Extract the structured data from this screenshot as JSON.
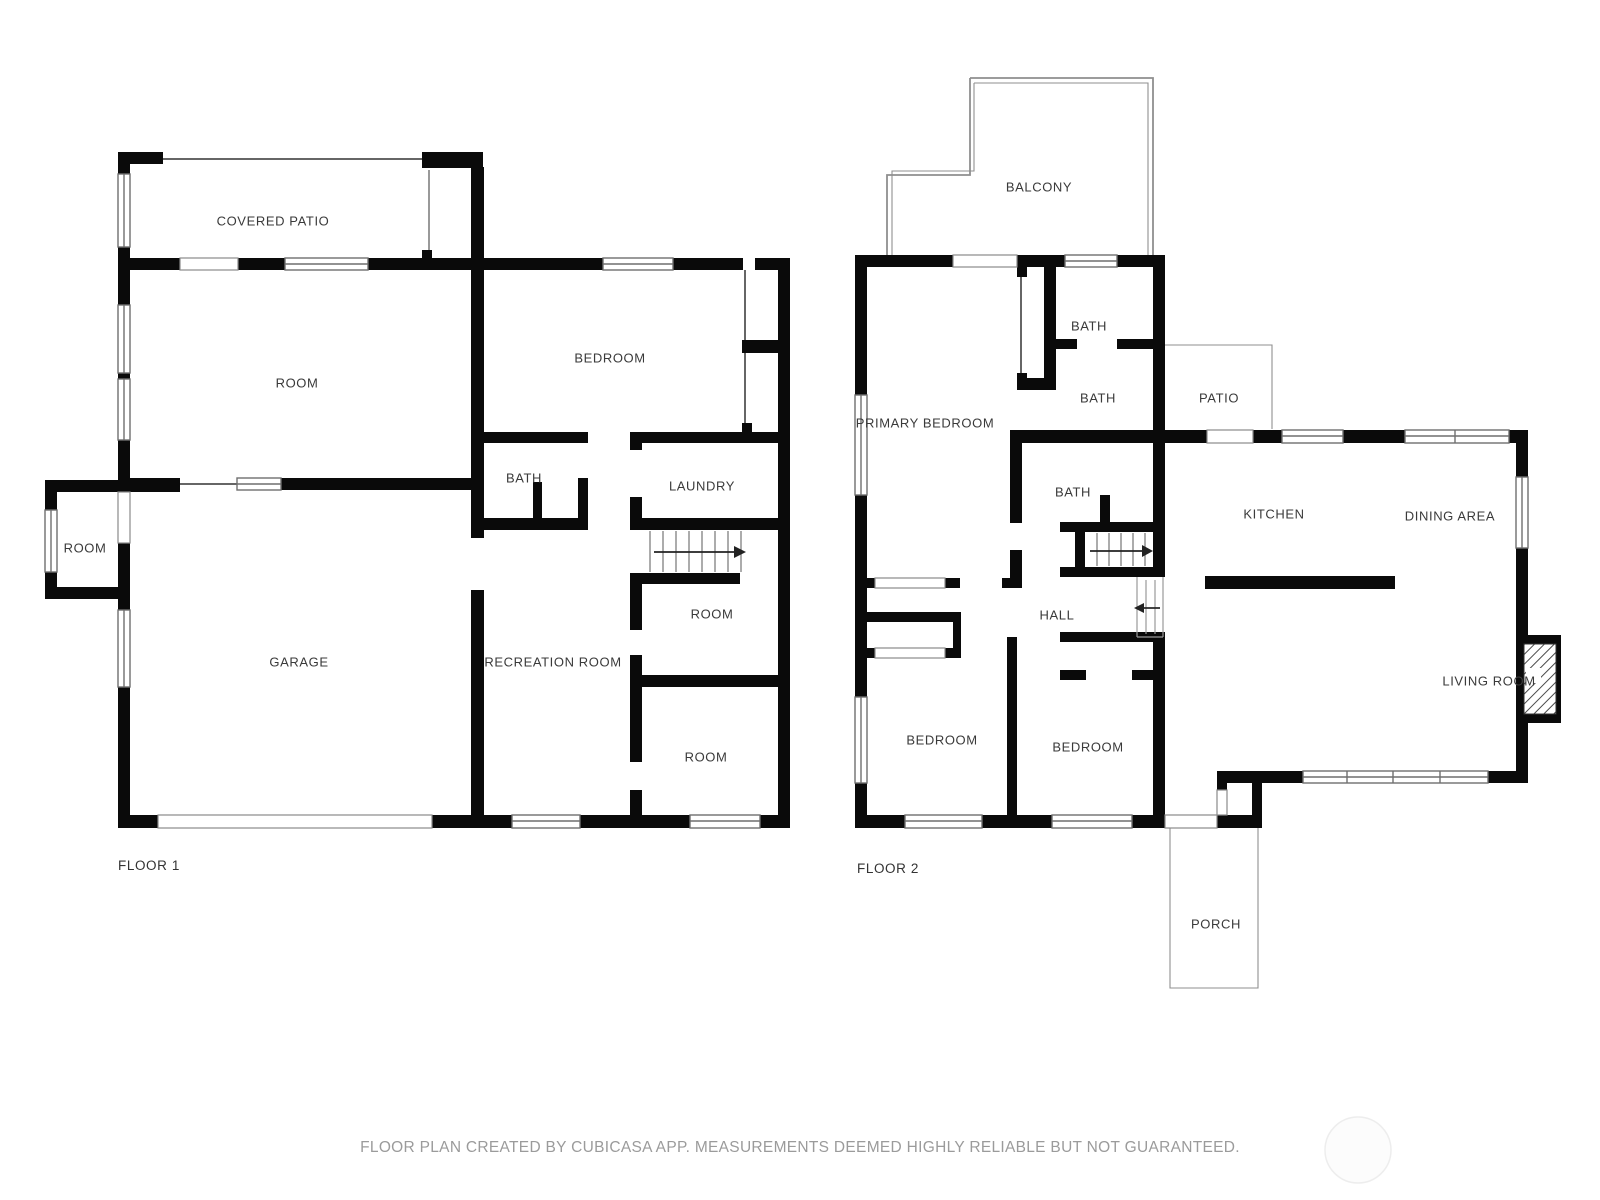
{
  "floor1": {
    "name": "FLOOR 1",
    "rooms": {
      "covered_patio": "COVERED PATIO",
      "room_upper": "ROOM",
      "bedroom": "BEDROOM",
      "bath": "BATH",
      "laundry": "LAUNDRY",
      "room_small": "ROOM",
      "room_mid": "ROOM",
      "garage": "GARAGE",
      "recreation": "RECREATION ROOM",
      "room_bottom": "ROOM"
    }
  },
  "floor2": {
    "name": "FLOOR 2",
    "rooms": {
      "balcony": "BALCONY",
      "primary_bedroom": "PRIMARY BEDROOM",
      "bath_top": "BATH",
      "bath_mid": "BATH",
      "bath_lower": "BATH",
      "patio": "PATIO",
      "kitchen": "KITCHEN",
      "dining": "DINING AREA",
      "hall": "HALL",
      "living": "LIVING ROOM",
      "bedroom_left": "BEDROOM",
      "bedroom_right": "BEDROOM",
      "porch": "PORCH"
    }
  },
  "footer": {
    "disclaimer": "FLOOR PLAN CREATED BY CUBICASA APP. MEASUREMENTS DEEMED HIGHLY RELIABLE BUT NOT GUARANTEED."
  },
  "colors": {
    "wall": "#0a0a0a",
    "label": "#3a3a3a",
    "outline": "#8f8f8f",
    "footer_text": "#9b9b9b"
  }
}
